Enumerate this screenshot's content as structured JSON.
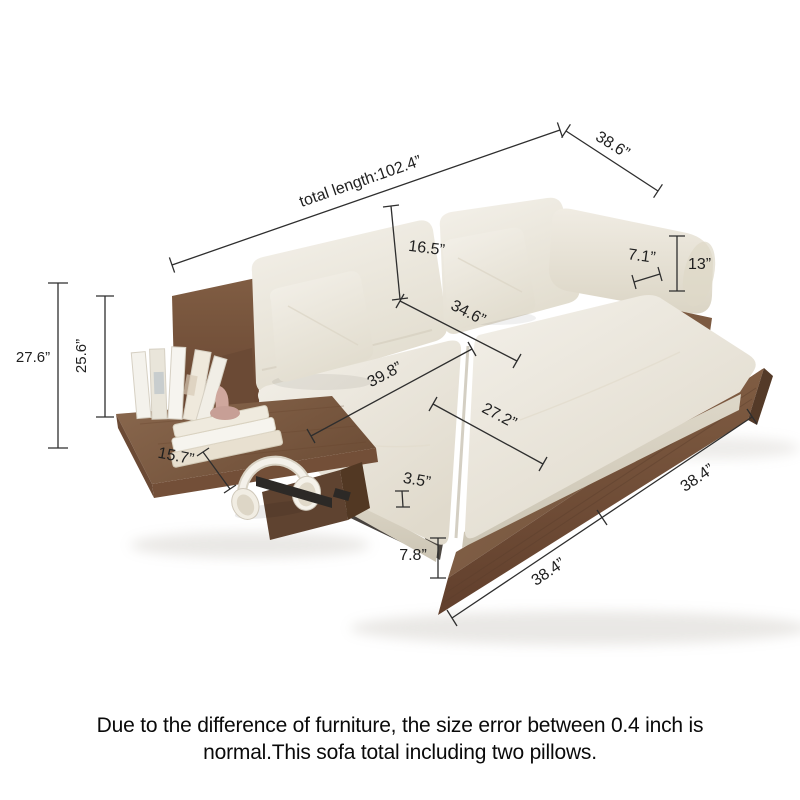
{
  "caption": {
    "line1": "Due to the difference of furniture, the size error between 0.4 inch is",
    "line2": "normal.This sofa total including two pillows."
  },
  "dimensions": {
    "total_length": "total length:102.4”",
    "seat_depth_overall": "38.6”",
    "back_cushion_height": "16.5”",
    "armrest_width": "7.1”",
    "armrest_height": "13”",
    "seat_width": "34.6”",
    "seat_length": "39.8”",
    "seat_cushion_width": "27.2”",
    "shelf_depth": "15.7”",
    "cushion_thickness": "3.5”",
    "base_height": "7.8”",
    "bed_front_left": "38.4”",
    "bed_front_right": "38.4”",
    "overall_height": "27.6”",
    "backrest_height": "25.6”"
  },
  "colors": {
    "wood": "#7c5a41",
    "wood_dark": "#5f4330",
    "cushion": "#ece8dd",
    "dimension_line": "#2e2e2e",
    "background": "#ffffff"
  }
}
